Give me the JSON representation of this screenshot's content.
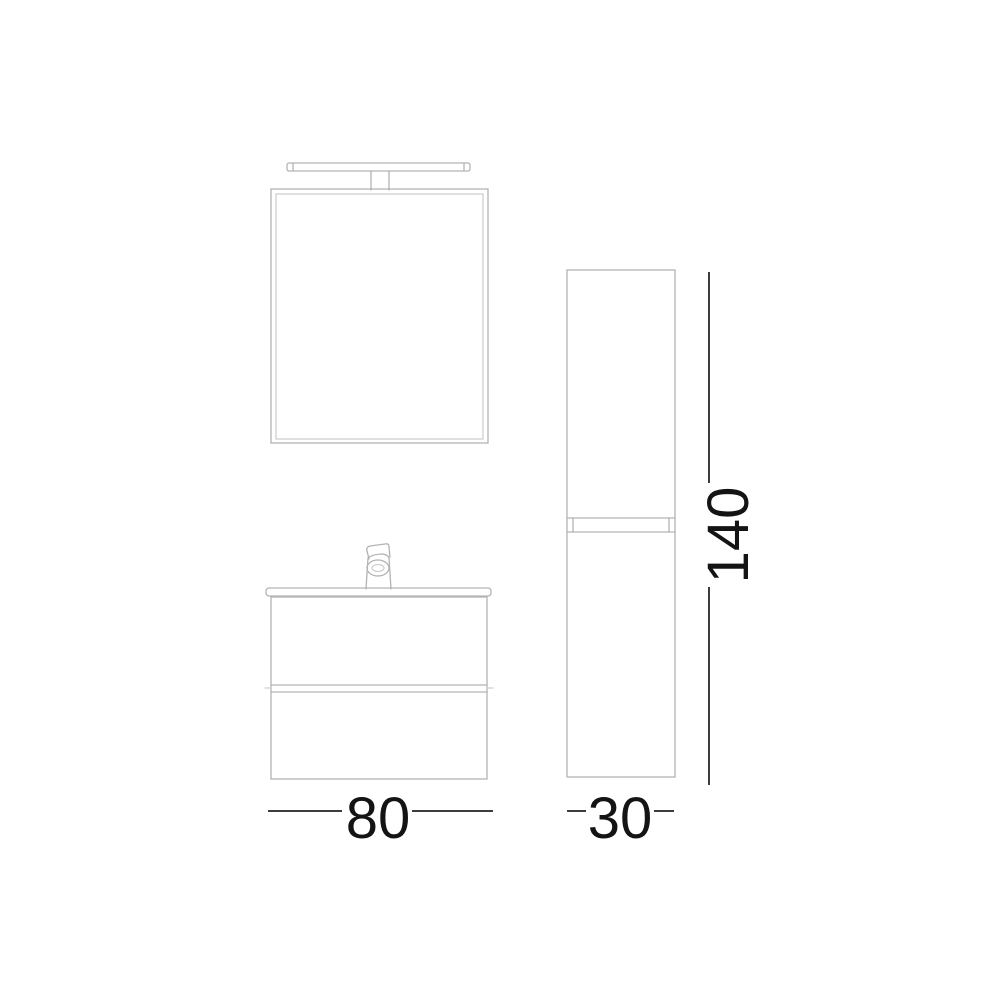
{
  "drawing": {
    "components": [
      "light-fixture",
      "mirror",
      "faucet",
      "washbasin-top",
      "vanity-cabinet-two-drawers",
      "tall-column-cabinet"
    ],
    "colors": {
      "background": "#ffffff",
      "furniture_outline": "#b3b3b3",
      "furniture_outline_light": "#cfcfcf",
      "dimension_line": "#3d3d3d",
      "dimension_text": "#141414"
    },
    "dimensions": {
      "vanity_width": {
        "value": "80"
      },
      "column_width": {
        "value": "30"
      },
      "column_height": {
        "value": "140"
      }
    }
  }
}
